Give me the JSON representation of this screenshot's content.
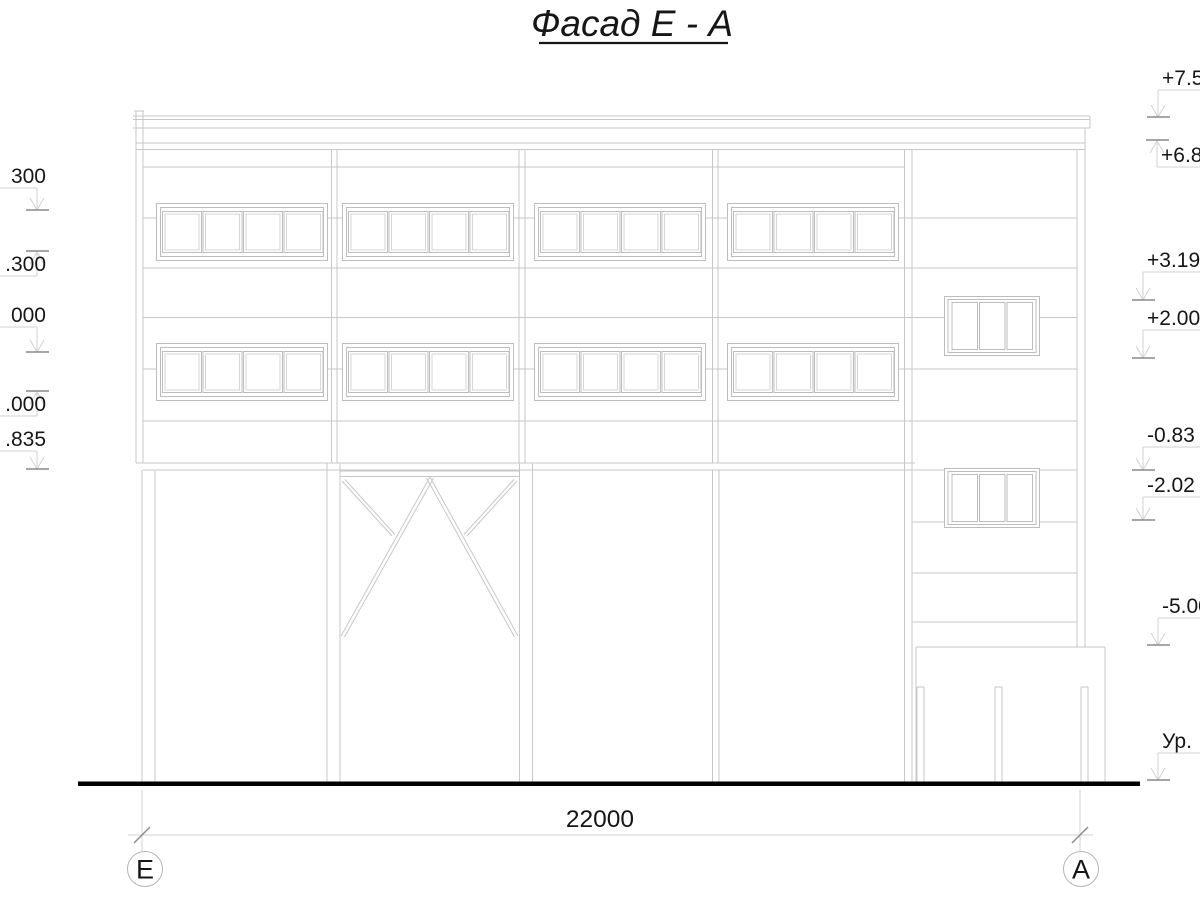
{
  "title": "Фасад Е - А",
  "dimension": {
    "total_label": "22000"
  },
  "axes": {
    "left": "Е",
    "right": "А"
  },
  "colors": {
    "line": "#c7c7c7",
    "text": "#161616",
    "ground": "#000000",
    "leader": "#d2d2d2"
  },
  "elevation_marks": {
    "right": [
      {
        "label": "+7.50",
        "ax": 1158,
        "uy": 90,
        "level": 117,
        "dir": "down"
      },
      {
        "label": "+6.8",
        "ax": 1157,
        "uy": 167,
        "level": 140,
        "dir": "up"
      },
      {
        "label": "+3.19",
        "ax": 1143,
        "uy": 272,
        "level": 300,
        "dir": "down"
      },
      {
        "label": "+2.00",
        "ax": 1143,
        "uy": 330,
        "level": 358,
        "dir": "down"
      },
      {
        "label": "-0.83",
        "ax": 1143,
        "uy": 447,
        "level": 470,
        "dir": "down"
      },
      {
        "label": "-2.02",
        "ax": 1143,
        "uy": 497,
        "level": 520,
        "dir": "down"
      },
      {
        "label": "-5.00",
        "ax": 1158,
        "uy": 618,
        "level": 645,
        "dir": "down"
      },
      {
        "label": "Ур.",
        "ax": 1158,
        "uy": 753,
        "level": 780,
        "dir": "down"
      }
    ],
    "left": [
      {
        "label": "300",
        "ax": 37,
        "uy": 188,
        "level": 210,
        "dir": "down"
      },
      {
        "label": ".300",
        "ax": 37,
        "uy": 276,
        "level": 251,
        "dir": "up"
      },
      {
        "label": "000",
        "ax": 37,
        "uy": 327,
        "level": 352,
        "dir": "down"
      },
      {
        "label": ".000",
        "ax": 37,
        "uy": 416,
        "level": 391,
        "dir": "up"
      },
      {
        "label": ".835",
        "ax": 37,
        "uy": 451,
        "level": 469,
        "dir": "down"
      }
    ]
  }
}
